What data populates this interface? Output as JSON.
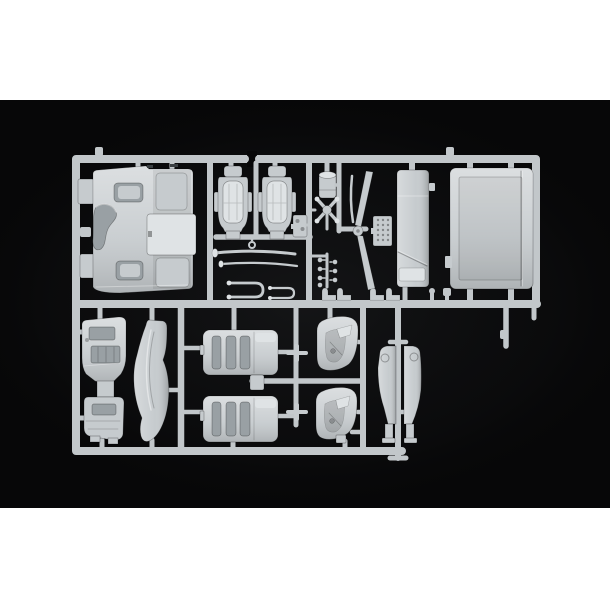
{
  "scene": {
    "type": "product-photo",
    "subject": "light grey injection-moulded plastic model kit sprue (truck cab interior parts) photographed on a black background with white page margins above and below",
    "text_visible": false
  },
  "colors": {
    "page_background": "#ffffff",
    "photo_background": "#070708",
    "plastic": "#c6cbce",
    "plastic_light": "#dfe3e5",
    "plastic_dark": "#a9afb3",
    "plastic_recess": "#99a0a4",
    "runner": "#c2c7ca",
    "outline_shadow": "#3a3f42"
  },
  "parts": [
    {
      "id": "sprue-runner-frame",
      "label": "moulding runner frame"
    },
    {
      "id": "cab-back-panel",
      "label": "cab rear wall panel"
    },
    {
      "id": "seat-backrest-left",
      "label": "seat backrest (left)"
    },
    {
      "id": "seat-backrest-right",
      "label": "seat backrest (right)"
    },
    {
      "id": "air-tank",
      "label": "air tank cylinder"
    },
    {
      "id": "cross-brace",
      "label": "X cross brace"
    },
    {
      "id": "pedal-bracket",
      "label": "pedal bracket"
    },
    {
      "id": "control-knobs",
      "label": "control knob cluster"
    },
    {
      "id": "intake-trumpets",
      "label": "intake trumpet rods"
    },
    {
      "id": "fork-linkages",
      "label": "fork linkages"
    },
    {
      "id": "wiper-arms",
      "label": "wiper arm levers"
    },
    {
      "id": "vent-grille",
      "label": "vent grille plate"
    },
    {
      "id": "bunk-side-panel",
      "label": "bunk side panel"
    },
    {
      "id": "roof-panel",
      "label": "large roof panel"
    },
    {
      "id": "dashboard",
      "label": "dashboard assembly"
    },
    {
      "id": "front-fender",
      "label": "front fender curve"
    },
    {
      "id": "seat-base-top",
      "label": "seat base (upper)"
    },
    {
      "id": "seat-base-bottom",
      "label": "seat base (lower)"
    },
    {
      "id": "door-card-top",
      "label": "door interior card (upper)"
    },
    {
      "id": "door-card-bottom",
      "label": "door interior card (lower)"
    },
    {
      "id": "corner-deflector-left",
      "label": "corner deflector (left)"
    },
    {
      "id": "corner-deflector-right",
      "label": "corner deflector (right)"
    }
  ]
}
